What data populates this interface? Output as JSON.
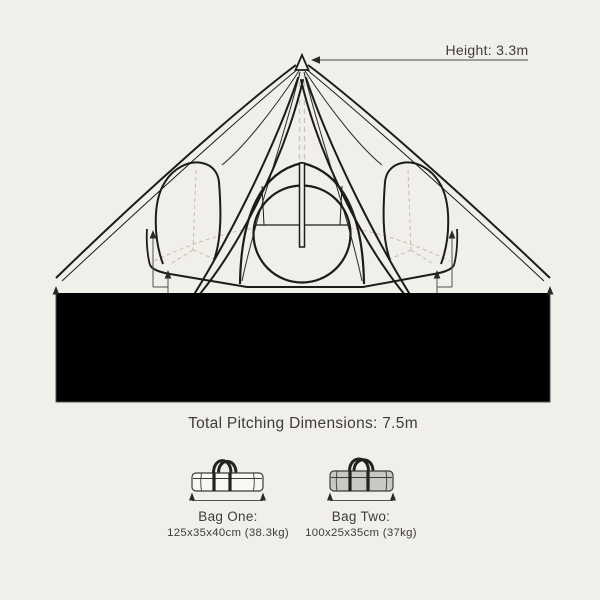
{
  "page": {
    "background_color": "#f1efe9",
    "ink_color": "#1d1c1a",
    "dimension_line_color": "#54524c",
    "text_color": "#3e3c37",
    "bag_two_fill": "#c9c8c2"
  },
  "tent": {
    "height_label": "Height: 3.3m",
    "left_offset_label": "25cm",
    "right_offset_label": "25cm",
    "floor_width_label": "Tent Floor Width: 5m",
    "pitching_label": "Total Pitching Dimensions: 7.5m"
  },
  "bags": [
    {
      "name": "Bag One:",
      "dimensions": "125x35x40cm (38.3kg)"
    },
    {
      "name": "Bag Two:",
      "dimensions": "100x25x35cm (37kg)"
    }
  ]
}
